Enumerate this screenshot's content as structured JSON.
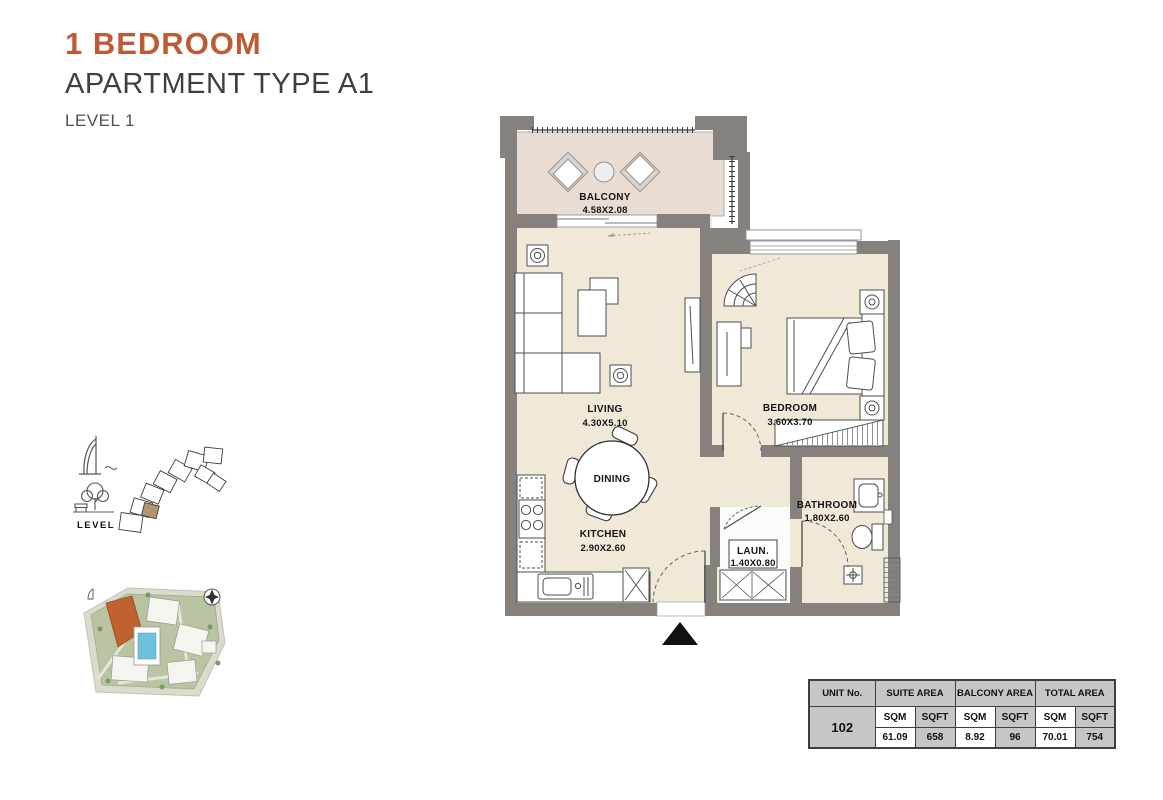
{
  "header": {
    "title": "1 BEDROOM",
    "subtitle": "APARTMENT TYPE A1",
    "level": "LEVEL 1"
  },
  "locator": {
    "level_label": "LEVEL 1"
  },
  "floorplan": {
    "balcony": {
      "name": "BALCONY",
      "dim": "4.58X2.08"
    },
    "living": {
      "name": "LIVING",
      "dim": "4.30X5.10"
    },
    "dining": {
      "name": "DINING"
    },
    "kitchen": {
      "name": "KITCHEN",
      "dim": "2.90X2.60"
    },
    "bedroom": {
      "name": "BEDROOM",
      "dim": "3.60X3.70"
    },
    "bathroom": {
      "name": "BATHROOM",
      "dim": "1.80X2.60"
    },
    "laundry": {
      "name": "LAUN.",
      "dim": "1.40X0.80"
    }
  },
  "area_table": {
    "col_unit": "UNIT No.",
    "col_suite": "SUITE AREA",
    "col_balcony": "BALCONY AREA",
    "col_total": "TOTAL AREA",
    "sqm": "SQM",
    "sqft": "SQFT",
    "unit_no": "102",
    "suite_sqm": "61.09",
    "suite_sqft": "658",
    "balcony_sqm": "8.92",
    "balcony_sqft": "96",
    "total_sqm": "70.01",
    "total_sqft": "754"
  },
  "colors": {
    "accent": "#bf5b34",
    "wall": "#86817d",
    "floor": "#f0e9d8",
    "balcony_floor": "#e9dcd2",
    "table_gray": "#c6c6c6",
    "highlight_unit": "#b5946f",
    "site_orange": "#c0622f",
    "pool_blue": "#6fc0dc"
  }
}
